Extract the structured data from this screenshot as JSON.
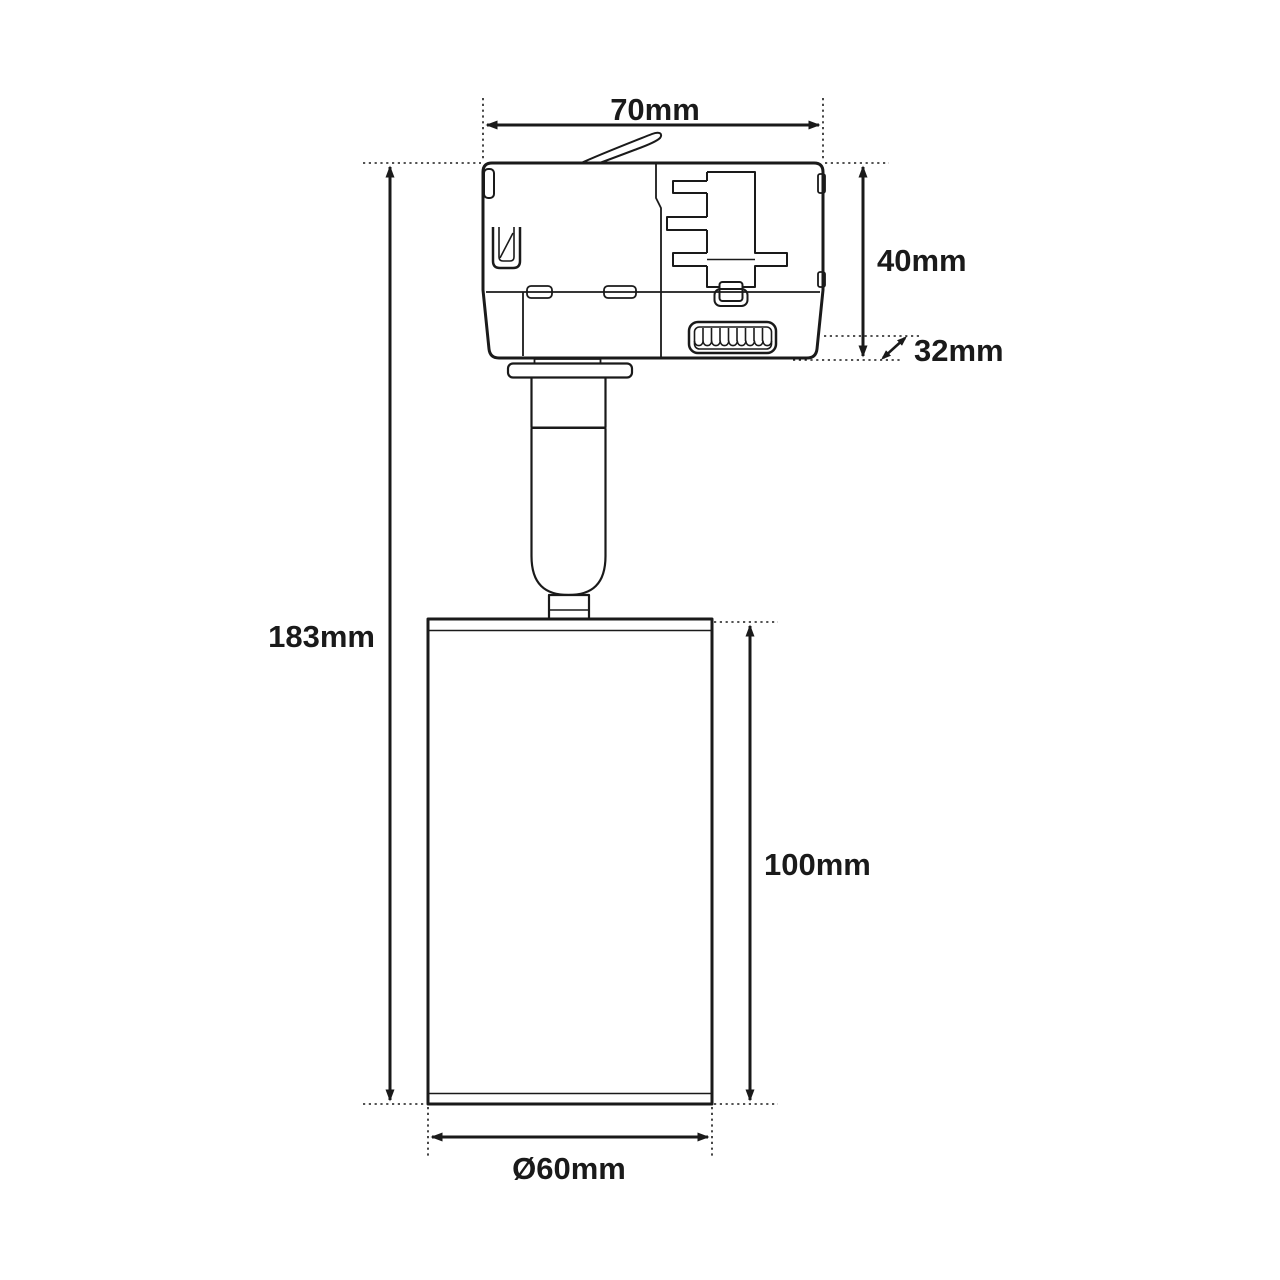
{
  "page": {
    "background_color": "#ffffff"
  },
  "diagram": {
    "type": "technical-dimension-drawing",
    "line_color": "#1a1a1a",
    "dimensions": {
      "adapter_width": "70mm",
      "adapter_height": "40mm",
      "adapter_depth": "32mm",
      "overall_height": "183mm",
      "lamp_body_height": "100mm",
      "lamp_body_diameter": "Ø60mm"
    }
  }
}
